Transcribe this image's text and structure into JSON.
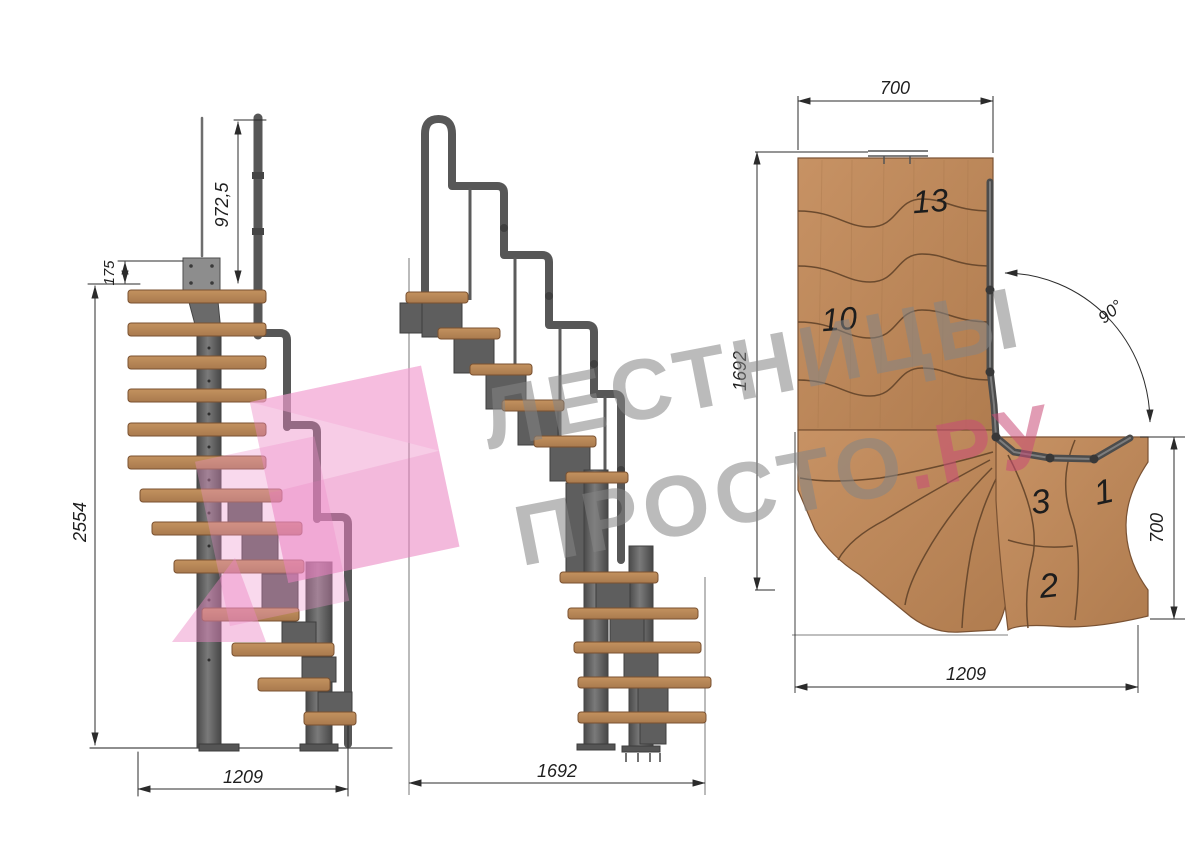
{
  "watermark": {
    "line1": "ЛЕСТНИЦЫ",
    "line2_gray": "ПРОСТО",
    "line2_accent": ".РУ",
    "gray_color": "#858585",
    "accent_color": "#c94d77",
    "logo_pink": "#ec86c4"
  },
  "front_view": {
    "dims": {
      "rail_height": "972,5",
      "plate_offset": "175",
      "total_height": "2554",
      "base_width": "1209"
    }
  },
  "side_view": {
    "dims": {
      "total_run": "1692"
    }
  },
  "plan_view": {
    "dims": {
      "top_width": "700",
      "left_run": "1692",
      "right_depth": "700",
      "bottom_width": "1209",
      "turn_angle": "90°"
    },
    "steps": {
      "top": "13",
      "mid": "10",
      "n3": "3",
      "n1": "1",
      "n2": "2"
    }
  },
  "colors": {
    "wood": "#b5865a",
    "wood_edge": "#7a5130",
    "wood_plan": "#bf8a5e",
    "steel": "#5d5d5d",
    "steel_dark": "#3f3f3f",
    "dim_line": "#2b2b2b",
    "background": "#ffffff"
  }
}
